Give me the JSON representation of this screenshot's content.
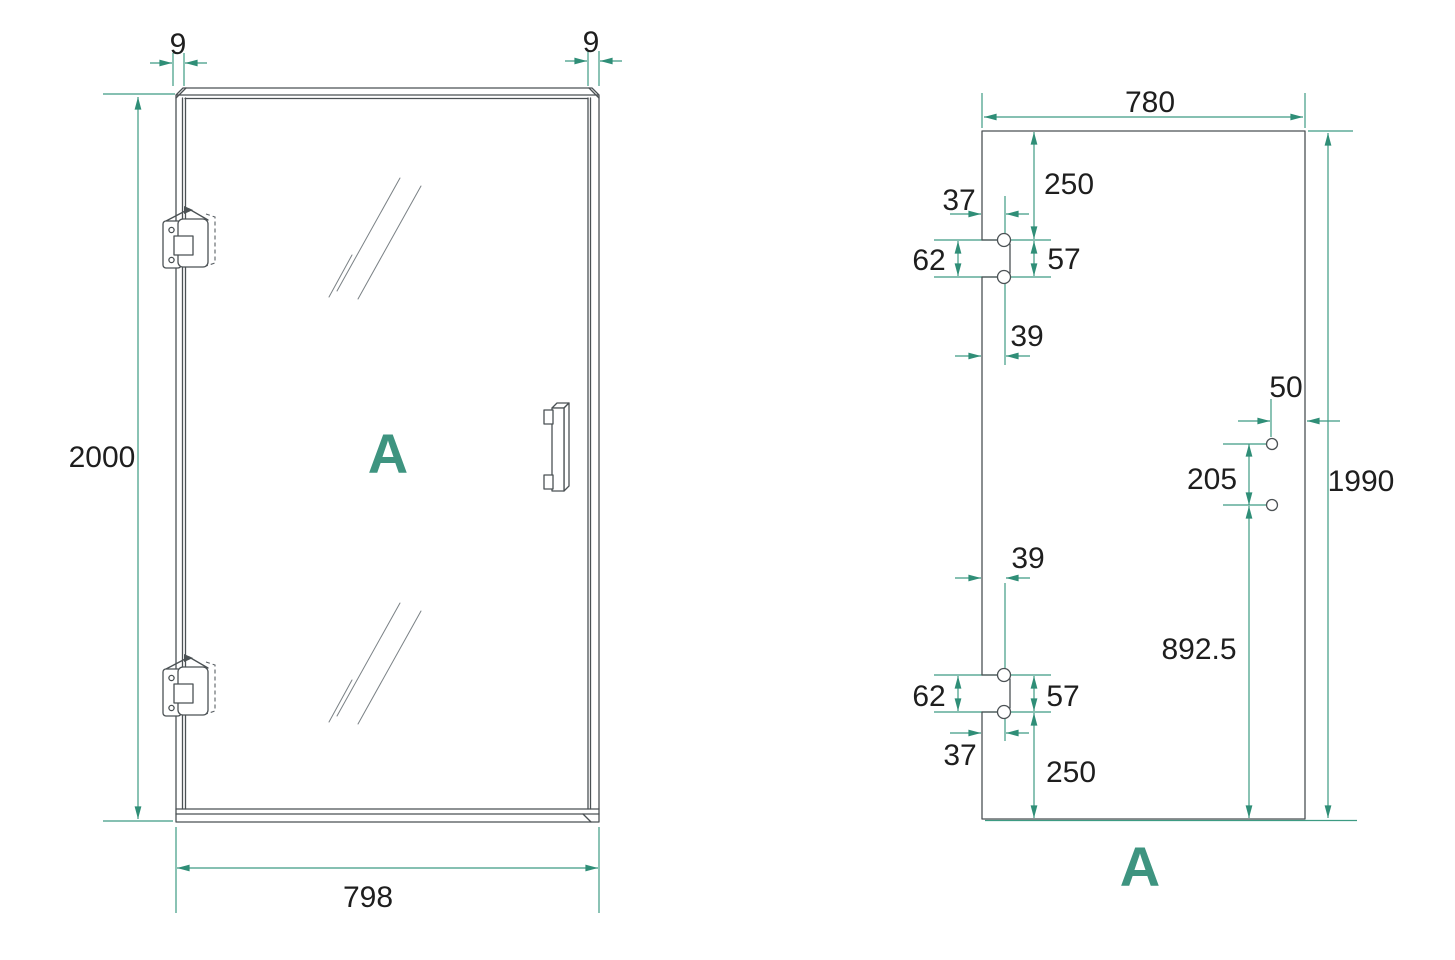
{
  "colors": {
    "accent_teal": "#3E9480",
    "dimension_teal": "#3D9B83",
    "arrow_teal": "#2F8E77",
    "drawing_line": "#4B5154",
    "text": "#1E1E1E",
    "background": "#FFFFFF"
  },
  "front_view": {
    "label": "A",
    "dims": {
      "frame_thickness_left": "9",
      "frame_thickness_right": "9",
      "overall_height": "2000",
      "overall_width": "798"
    }
  },
  "panel_view": {
    "label": "A",
    "dims": {
      "glass_width": "780",
      "glass_height": "1990",
      "top_notch_from_top": "250",
      "top_notch_edge": "37",
      "top_notch_height": "62",
      "top_hole_pitch": "57",
      "top_notch_depth": "39",
      "handle_from_edge": "50",
      "handle_hole_pitch": "205",
      "handle_from_bottom": "892.5",
      "bottom_notch_depth": "39",
      "bottom_notch_height": "62",
      "bottom_hole_pitch": "57",
      "bottom_notch_edge": "37",
      "bottom_notch_from_bottom": "250"
    }
  }
}
